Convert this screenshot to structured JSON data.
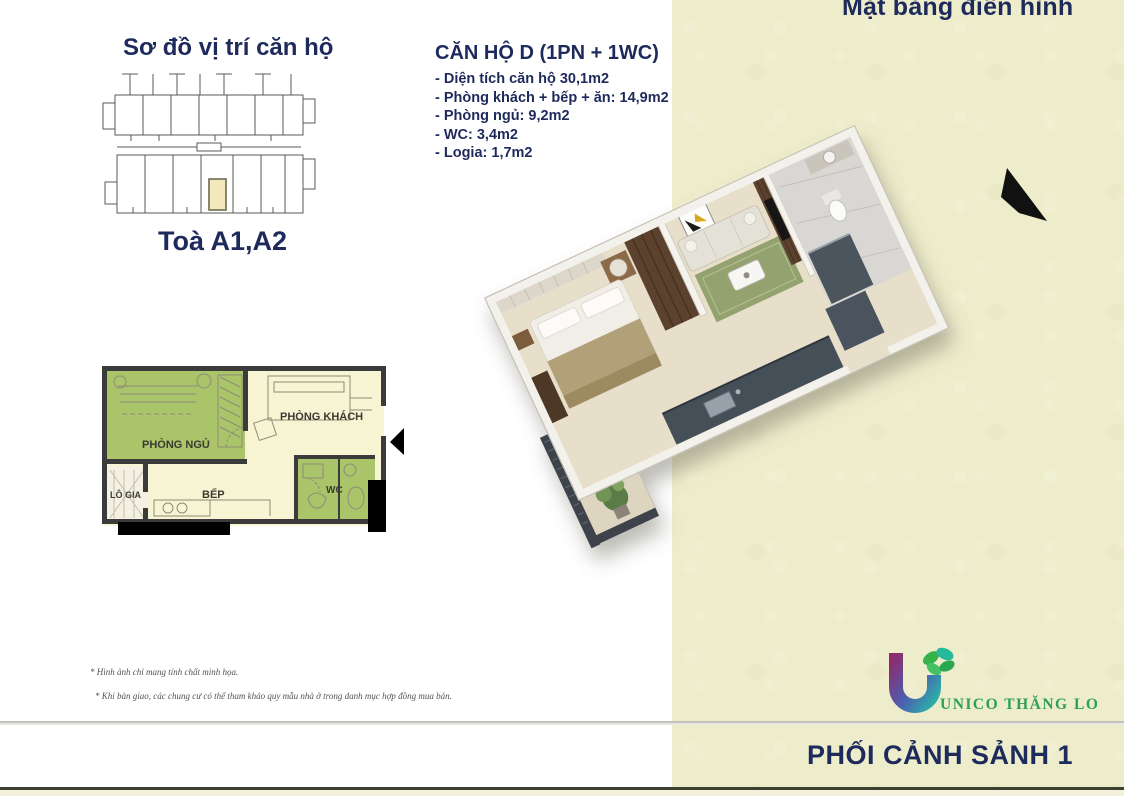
{
  "header": {
    "title": "Mặt bằng điển hình"
  },
  "site_plan": {
    "title": "Sơ đồ vị trí căn hộ",
    "tower_label": "Toà A1,A2"
  },
  "apartment_info": {
    "heading": "CĂN HỘ D (1PN + 1WC)",
    "items": [
      "- Diện tích căn hộ 30,1m2",
      "- Phòng khách + bếp + ăn: 14,9m2",
      "- Phòng ngủ: 9,2m2",
      "- WC: 3,4m2",
      "- Logia: 1,7m2"
    ]
  },
  "floor_plan_2d": {
    "rooms": {
      "bedroom": "PHÒNG NGỦ",
      "living": "PHÒNG KHÁCH",
      "loggia": "LÔ GIA",
      "kitchen": "BẾP",
      "wc": "WC"
    }
  },
  "footnotes": [
    "* Hình ảnh chỉ mang tính chất minh họa.",
    "* Khi bàn giao, các chung cư có thể tham khảo quy mẫu nhà ở trong danh mục hợp đồng mua bán."
  ],
  "footer": {
    "logo_text": "UNICO THĂNG LONG",
    "caption": "PHỐI CẢNH SẢNH 1"
  },
  "colors": {
    "navy_text": "#1e2a5c",
    "side_band": "#eeedcb",
    "plan_green": "#a9c469",
    "plan_cream": "#f7f4d3",
    "plan_wall": "#3b3b3b",
    "site_highlight": "#f3e9ba",
    "logo_green": "#2f9e56"
  }
}
